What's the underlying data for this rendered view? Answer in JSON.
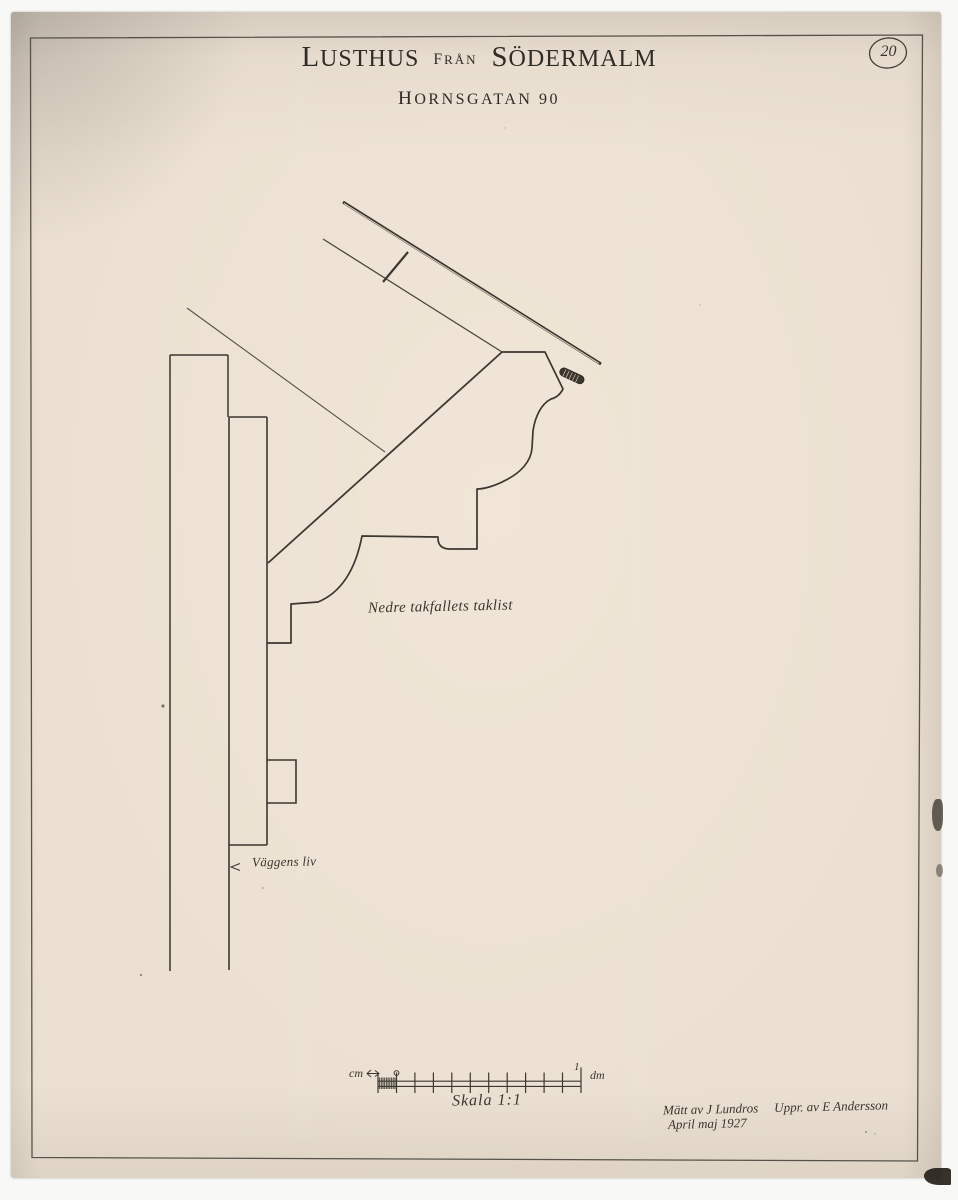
{
  "meta": {
    "sheet_number": "20"
  },
  "title": {
    "word1": "LUSTHUS",
    "word2": "FRÅN",
    "word3": "SÖDERMALM",
    "line2": "HORNSGATAN 90"
  },
  "annotations": {
    "cornice_label": "Nedre takfallets taklist",
    "wall_label": "Väggens liv"
  },
  "scale_bar": {
    "left_unit": "cm",
    "right_unit": "dm",
    "end_tick_label": "1",
    "caption": "Skala 1:1"
  },
  "signature": {
    "measured_by": "Mätt av J Lundros",
    "drawn_by": "Uppr. av E Andersson",
    "date": "April maj 1927"
  },
  "colors": {
    "paper": "#ebe0d1",
    "ink": "#3a362f",
    "frame_line": "#56524b",
    "scan_background": "#f8f8f6"
  }
}
